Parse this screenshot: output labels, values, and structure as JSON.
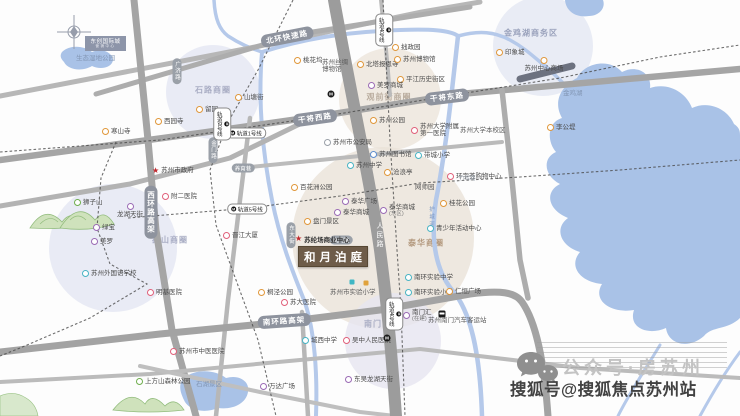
{
  "page": {
    "width": 740,
    "height": 416
  },
  "property": {
    "name": "和月泊庭",
    "marker_label": "苏纶场商业中心"
  },
  "project_box": {
    "title": "东创国际城",
    "subtitle": "营销中心"
  },
  "watermark": {
    "gzh_line": "公众号·房苏州",
    "sohu_line": "搜狐号@搜狐焦点苏州站"
  },
  "bubbles": [
    {
      "label": "石路商圈",
      "cx": 213,
      "cy": 92,
      "r": 47,
      "fill": "#e3e6f2",
      "tx": 213,
      "ty": 90,
      "tc": "#a9adc4"
    },
    {
      "label": "观前街商圈",
      "cx": 390,
      "cy": 99,
      "r": 51,
      "fill": "#ece5db",
      "tx": 389,
      "ty": 97,
      "tc": "#b9ac9e"
    },
    {
      "label": "泰华商圈",
      "cx": 383,
      "cy": 238,
      "r": 91,
      "fill": "#eae2d8",
      "tx": 426,
      "ty": 243,
      "tc": "#b2977c"
    },
    {
      "label": "狮山商圈",
      "cx": 113,
      "cy": 248,
      "r": 64,
      "fill": "#e3e6f2",
      "tx": 170,
      "ty": 240,
      "tc": "#a9adc4"
    },
    {
      "label": "南门商圈",
      "cx": 393,
      "cy": 341,
      "r": 48,
      "fill": "#e6e5f0",
      "tx": 382,
      "ty": 324,
      "tc": "#a9adc4"
    },
    {
      "label": "金鸡湖商务区",
      "cx": 543,
      "cy": 46,
      "r": 50,
      "fill": "#e4e7f3",
      "tx": 531,
      "ty": 33,
      "tc": "#9aa2bc"
    }
  ],
  "labels": [
    {
      "t": "寒山寺",
      "x": 105,
      "y": 132,
      "k": "or"
    },
    {
      "t": "西园寺",
      "x": 158,
      "y": 122,
      "k": "or"
    },
    {
      "t": "留园",
      "x": 199,
      "y": 110,
      "k": "or"
    },
    {
      "t": "山塘街",
      "x": 238,
      "y": 98,
      "k": "or"
    },
    {
      "t": "桃花坞",
      "x": 297,
      "y": 61,
      "k": "or"
    },
    {
      "t": "北塔报恩寺",
      "x": 360,
      "y": 65,
      "k": "or"
    },
    {
      "t": "拙政园",
      "x": 395,
      "y": 48,
      "k": "or"
    },
    {
      "t": "苏州博物馆",
      "x": 397,
      "y": 60,
      "k": "or"
    },
    {
      "t": "平江历史街区",
      "x": 400,
      "y": 80,
      "k": "or"
    },
    {
      "t": "美罗商城",
      "x": 371,
      "y": 86,
      "k": "pu"
    },
    {
      "t": "苏州丝绸博物馆",
      "x": 322,
      "y": 63,
      "k": "pl",
      "w": 30
    },
    {
      "t": "苏州公园",
      "x": 373,
      "y": 121,
      "k": "or"
    },
    {
      "t": "苏州大学附属第一医院",
      "x": 414,
      "y": 127,
      "k": "pk",
      "w": 42
    },
    {
      "t": "苏州大学本校区",
      "x": 460,
      "y": 131,
      "k": "pl"
    },
    {
      "t": "苏州市公安局",
      "x": 327,
      "y": 143,
      "k": "gy"
    },
    {
      "t": "苏州图书馆",
      "x": 373,
      "y": 155,
      "k": "bl"
    },
    {
      "t": "带城小学",
      "x": 418,
      "y": 156,
      "k": "te"
    },
    {
      "t": "苏州中学",
      "x": 350,
      "y": 166,
      "k": "te"
    },
    {
      "t": "沧浪亭",
      "x": 387,
      "y": 173,
      "k": "or"
    },
    {
      "t": "环宇荟购物中心",
      "x": 450,
      "y": 177,
      "k": "pk"
    },
    {
      "t": "网师园",
      "x": 415,
      "y": 188,
      "k": "pl"
    },
    {
      "t": "竹辉路",
      "x": 459,
      "y": 180,
      "k": "tiny"
    },
    {
      "t": "百花洲公园",
      "x": 294,
      "y": 188,
      "k": "or"
    },
    {
      "t": "泰华广场",
      "x": 345,
      "y": 202,
      "k": "pu"
    },
    {
      "t": "泰华商城",
      "x": 337,
      "y": 213,
      "k": "pu"
    },
    {
      "t": "泰华商城",
      "x": 383,
      "y": 208,
      "k": "pu",
      "t2": "(东区)"
    },
    {
      "t": "桂花公园",
      "x": 443,
      "y": 204,
      "k": "or"
    },
    {
      "t": "盘门景区",
      "x": 307,
      "y": 222,
      "k": "or"
    },
    {
      "t": "青少年活动中心",
      "x": 430,
      "y": 229,
      "k": "te"
    },
    {
      "t": "晋江大厦",
      "x": 226,
      "y": 236,
      "k": "pk"
    },
    {
      "t": "苏州市政府",
      "x": 155,
      "y": 171,
      "k": "st"
    },
    {
      "t": "附二医院",
      "x": 165,
      "y": 197,
      "k": "pk"
    },
    {
      "t": "狮子山",
      "x": 77,
      "y": 203,
      "k": "gr"
    },
    {
      "t": "龙湖天街",
      "x": 130,
      "y": 206,
      "k": "pu",
      "b": true
    },
    {
      "t": "绿宝",
      "x": 96,
      "y": 228,
      "k": "pu"
    },
    {
      "t": "美罗",
      "x": 94,
      "y": 242,
      "k": "pu"
    },
    {
      "t": "苏州外国语学校",
      "x": 85,
      "y": 274,
      "k": "te"
    },
    {
      "t": "明基医院",
      "x": 150,
      "y": 293,
      "k": "pk"
    },
    {
      "t": "苏州市中医医院",
      "x": 173,
      "y": 352,
      "k": "pk"
    },
    {
      "t": "上方山森林公园",
      "x": 139,
      "y": 382,
      "k": "gr"
    },
    {
      "t": "石湖景区",
      "x": 196,
      "y": 385,
      "k": "wt"
    },
    {
      "t": "桐泾公园",
      "x": 261,
      "y": 293,
      "k": "or"
    },
    {
      "t": "苏大医院",
      "x": 284,
      "y": 303,
      "k": "pk"
    },
    {
      "t": "城西中学",
      "x": 305,
      "y": 341,
      "k": "te"
    },
    {
      "t": "万达广场",
      "x": 263,
      "y": 387,
      "k": "pu"
    },
    {
      "t": "东吴龙湖天街",
      "x": 348,
      "y": 380,
      "k": "pu"
    },
    {
      "t": "吴中人民医院",
      "x": 346,
      "y": 341,
      "k": "pk"
    },
    {
      "t": "苏州市实验小学",
      "x": 330,
      "y": 293,
      "k": "pl"
    },
    {
      "t": "南环实验中学",
      "x": 408,
      "y": 278,
      "k": "te"
    },
    {
      "t": "南环实验小学",
      "x": 408,
      "y": 293,
      "k": "te"
    },
    {
      "t": "仁恒广场",
      "x": 449,
      "y": 292,
      "k": "or"
    },
    {
      "t": "南门汇",
      "x": 406,
      "y": 313,
      "k": "pu",
      "t2": "(在建)"
    },
    {
      "t": "苏州南门汽车客运站",
      "x": 428,
      "y": 321,
      "k": "pl"
    },
    {
      "t": "印象城",
      "x": 499,
      "y": 53,
      "k": "or"
    },
    {
      "t": "苏州中心商场",
      "x": 544,
      "y": 60,
      "k": "or",
      "b": true
    },
    {
      "t": "李公堤",
      "x": 550,
      "y": 128,
      "k": "or"
    },
    {
      "t": "金鸡湖",
      "x": 563,
      "y": 94,
      "k": "wt"
    },
    {
      "t": "生态湿地公园",
      "x": 76,
      "y": 59,
      "k": "wt"
    }
  ],
  "road_pills": [
    {
      "t": "干将西路",
      "x": 315,
      "y": 118,
      "rot": -8,
      "cls": "big"
    },
    {
      "t": "干将东路",
      "x": 447,
      "y": 97,
      "rot": -7,
      "cls": "big"
    },
    {
      "t": "北环快速路",
      "x": 287,
      "y": 37,
      "rot": -11,
      "cls": "big"
    },
    {
      "t": "南环路高架",
      "x": 284,
      "y": 321,
      "rot": -4,
      "cls": "big"
    },
    {
      "t": "西环路高架",
      "x": 151,
      "y": 212,
      "rot": 90,
      "cls": "big"
    },
    {
      "t": "广济路",
      "x": 177,
      "y": 71,
      "rot": 90,
      "cls": "small"
    },
    {
      "t": "金门路",
      "x": 213,
      "y": 150,
      "rot": 90,
      "cls": "small"
    },
    {
      "t": "养育巷",
      "x": 243,
      "y": 168,
      "rot": 0,
      "cls": "small"
    },
    {
      "t": "南门路",
      "x": 341,
      "y": 240,
      "rot": 0,
      "cls": "small"
    },
    {
      "t": "东大街",
      "x": 291,
      "y": 235,
      "rot": 90,
      "cls": "small"
    }
  ],
  "metro_pills": [
    {
      "t": "轨道1号线",
      "x": 246,
      "y": 133,
      "rot": 0
    },
    {
      "t": "轨道2号线",
      "x": 222,
      "y": 124,
      "rot": 90
    },
    {
      "t": "轨道4号线",
      "x": 384,
      "y": 30,
      "rot": 90
    },
    {
      "t": "轨道4号线",
      "x": 394,
      "y": 314,
      "rot": 90
    },
    {
      "t": "轨道5号线",
      "x": 247,
      "y": 209,
      "rot": 0
    }
  ],
  "on_road_labels": [
    {
      "t": "人民路",
      "x": 374,
      "y": 222,
      "color": "#ffffff",
      "size": 7
    },
    {
      "t": "护城河",
      "x": 427,
      "y": 206,
      "color": "#7e99c4",
      "size": 5.5
    }
  ],
  "icons": [
    {
      "name": "metro-station-icon",
      "x": 331,
      "y": 94
    },
    {
      "name": "metro-station-icon",
      "x": 387,
      "y": 338
    },
    {
      "name": "bus-station-icon",
      "x": 442,
      "y": 314
    },
    {
      "name": "school-icon-teal",
      "x": 352,
      "y": 282,
      "color": "#3fb6c4"
    },
    {
      "name": "school-icon-amber",
      "x": 366,
      "y": 283,
      "color": "#e0a23c"
    }
  ]
}
